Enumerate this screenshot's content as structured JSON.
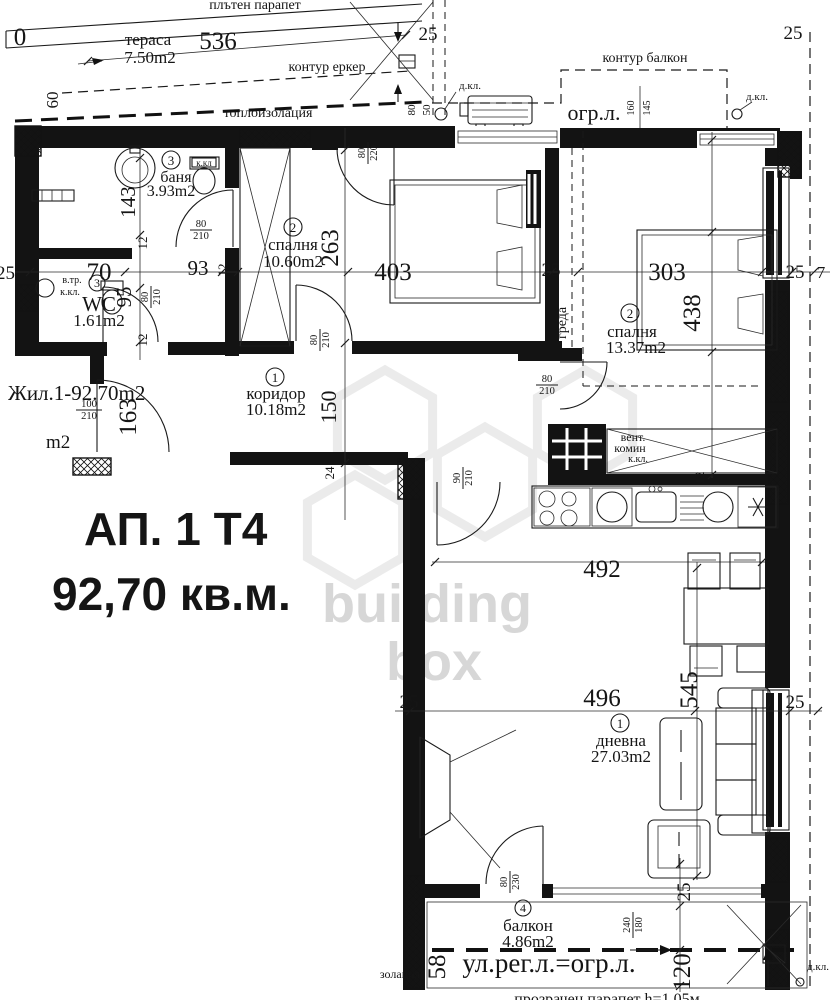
{
  "title": {
    "apartment": "АП. 1 Т4",
    "area": "92,70 кв.м.",
    "unit_label": "Жил.1-92.70m2",
    "stray_m2": "m2"
  },
  "watermark": {
    "line1": "building",
    "line2": "box"
  },
  "rooms": {
    "terrace": {
      "name": "тераса",
      "area": "7.50m2"
    },
    "bath": {
      "num": "3",
      "name": "баня",
      "area": "3.93m2"
    },
    "wc": {
      "num": "3",
      "name": "WC",
      "area": "1.61m2"
    },
    "bedroom1": {
      "num": "2",
      "name": "спалня",
      "area": "10.60m2"
    },
    "bedroom2": {
      "num": "2",
      "name": "спалня",
      "area": "13.37m2"
    },
    "corridor": {
      "num": "1",
      "name": "коридор",
      "area": "10.18m2"
    },
    "living": {
      "num": "1",
      "name": "дневна",
      "area": "27.03m2"
    },
    "balcony": {
      "num": "4",
      "name": "балкон",
      "area": "4.86m2"
    }
  },
  "annotations": {
    "parapet_top": "плътен парапет",
    "bay_contour": "контур еркер",
    "insulation_top": "топлоизолация",
    "balcony_contour": "контур балкон",
    "ogr_l": "огр.л.",
    "d_kl": "д.кл.",
    "k_kl": "к.кл.",
    "k_kl_small": "к.кл",
    "v_tr": "в.тр.",
    "vent_line1": "вент.",
    "vent_line2": "комин",
    "greda": "греда",
    "street_line": "ул.рег.л.=огр.л.",
    "insulation_bottom": "золация",
    "parapet_bottom": "прозрачен парапет h=1.05м"
  },
  "dims": {
    "d0": "0",
    "d7": "7",
    "d12": "12",
    "d24": "24",
    "d25": "25",
    "d50": "50",
    "d58": "58",
    "d60": "60",
    "d70": "70",
    "d80": "80",
    "d90": "90",
    "d93": "93",
    "d95": "95",
    "d100": "100",
    "d120": "120",
    "d143": "143",
    "d145": "145",
    "d150": "150",
    "d160": "160",
    "d163": "163",
    "d180": "180",
    "d210": "210",
    "d220": "220",
    "d230": "230",
    "d240": "240",
    "d263": "263",
    "d303": "303",
    "d403": "403",
    "d438": "438",
    "d492": "492",
    "d496": "496",
    "d536": "536",
    "d545": "545"
  }
}
